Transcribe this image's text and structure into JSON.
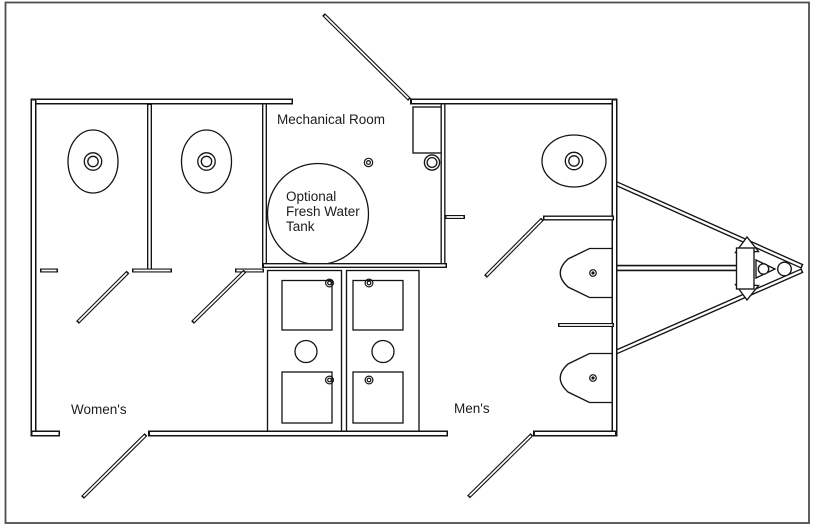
{
  "canvas": {
    "background": "#ffffff",
    "border_color": "#4f4f4f",
    "line_color": "#141414",
    "text_color": "#1c1c1c"
  },
  "labels": {
    "mechanical_room": "Mechanical Room",
    "tank": {
      "line1": "Optional",
      "line2": "Fresh Water",
      "line3": "Tank"
    },
    "womens_room": "Women's",
    "mens_room": "Men's"
  },
  "fixtures": {
    "womens_toilets": 2,
    "mens_toilets": 1,
    "urinals": 2,
    "sink_basins": 4,
    "fresh_water_tanks": 1,
    "entry_doors": 3,
    "interior_doors": 3
  }
}
